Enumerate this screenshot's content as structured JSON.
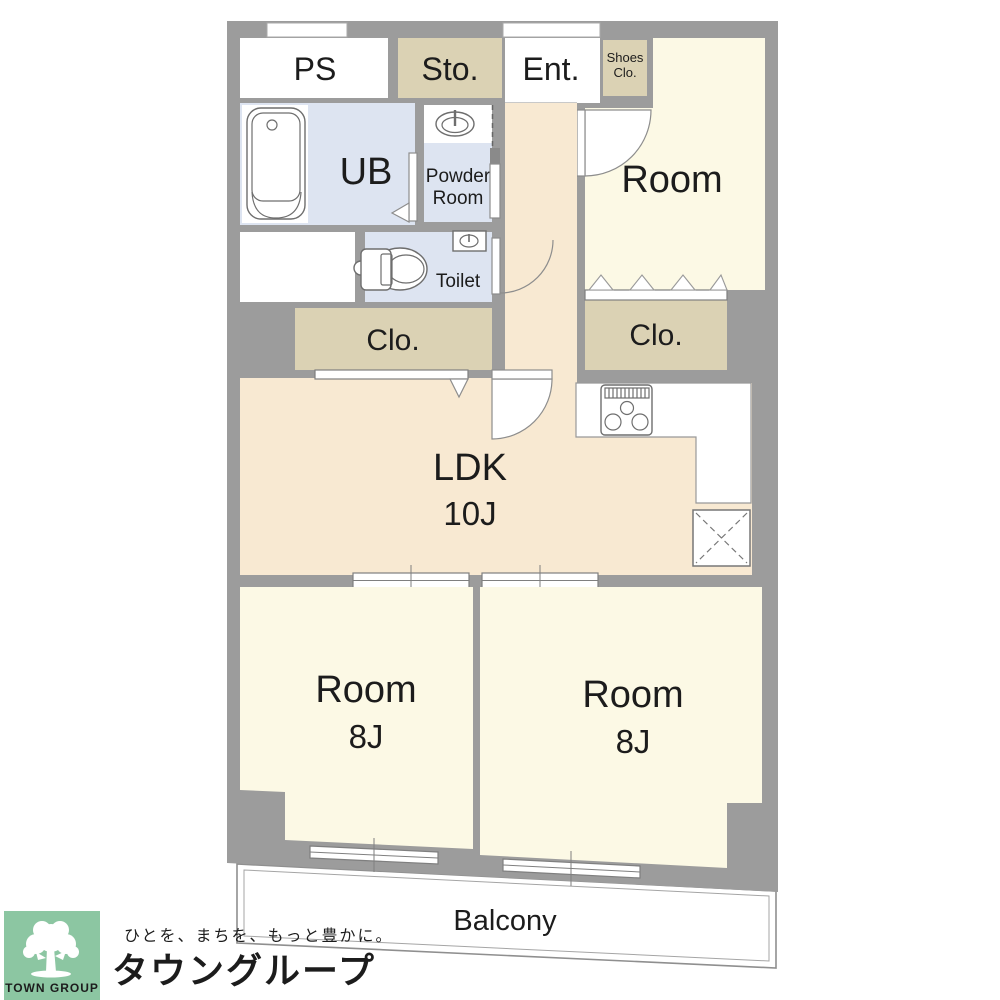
{
  "floor_plan": {
    "rooms": {
      "ps": {
        "label": "PS"
      },
      "storage": {
        "label": "Sto."
      },
      "entrance": {
        "label": "Ent."
      },
      "shoes_closet": {
        "line1": "Shoes",
        "line2": "Clo."
      },
      "unit_bath": {
        "label": "UB"
      },
      "powder_room": {
        "line1": "Powder",
        "line2": "Room"
      },
      "toilet": {
        "label": "Toilet"
      },
      "closet_hall": {
        "label": "Clo."
      },
      "closet_bedroom": {
        "label": "Clo."
      },
      "bedroom_top_right": {
        "label": "Room"
      },
      "ldk": {
        "label": "LDK",
        "size": "10J"
      },
      "bedroom_bottom_left": {
        "label": "Room",
        "size": "8J"
      },
      "bedroom_bottom_right": {
        "label": "Room",
        "size": "8J"
      },
      "balcony": {
        "label": "Balcony"
      }
    },
    "icons": [
      "bathtub",
      "washbasin",
      "toilet",
      "hand-sink",
      "gas-stove",
      "refrigerator-space",
      "door-swing",
      "folding-closet-door",
      "sliding-door",
      "window"
    ],
    "colors": {
      "wall": "#9C9C9C",
      "bedroom_fill": "#FCF9E5",
      "ldk_fill": "#F8E9D2",
      "wet_area_fill": "#DDE4F1",
      "closet_fill": "#DBD2B4"
    }
  },
  "branding": {
    "logo_square_text": "TOWN GROUP",
    "tagline": "ひとを、まちを、もっと豊かに。",
    "company_name": "タウングループ",
    "logo_bg_color": "#8CC6A2",
    "tagline_color": "#8AC6A2",
    "company_name_color": "#5FBA8B"
  }
}
